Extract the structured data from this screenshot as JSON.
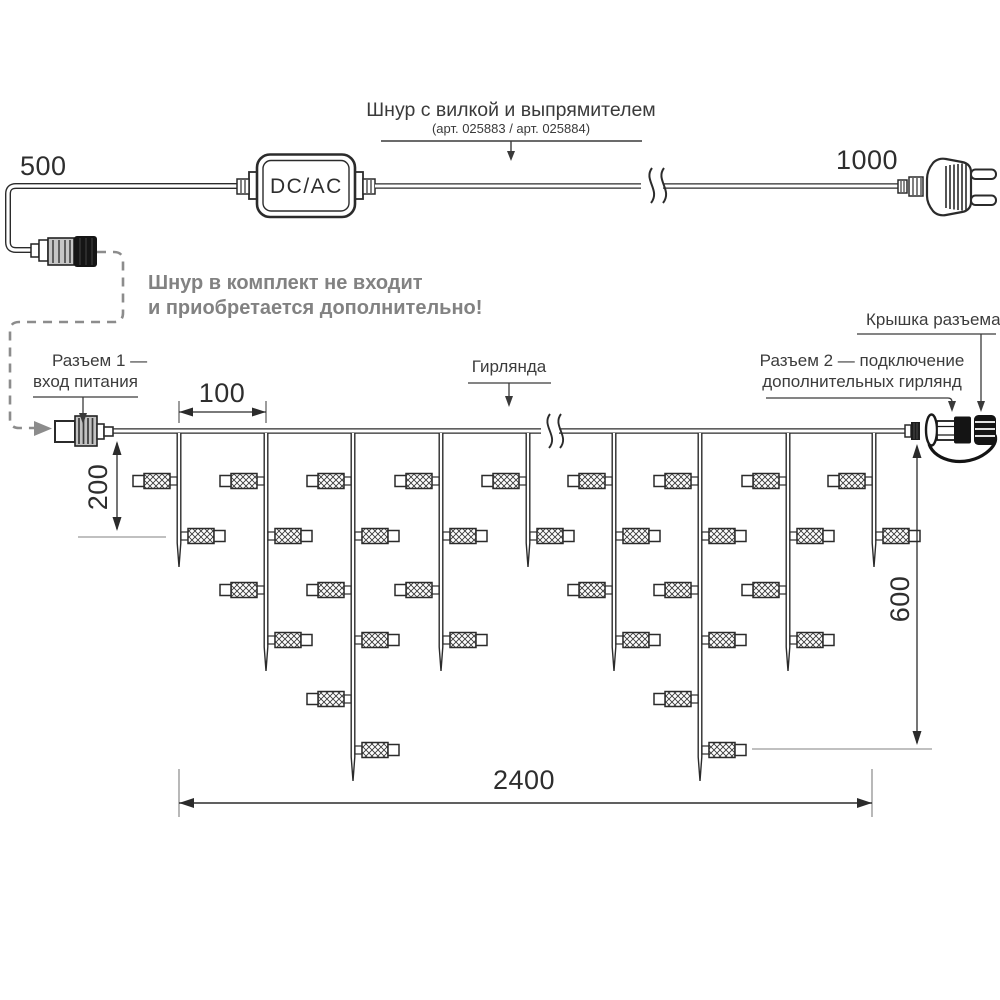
{
  "power_cord": {
    "title": "Шнур с вилкой и выпрямителем",
    "subtitle": "(арт. 025883 / арт. 025884)",
    "converter_label": "DC/AC",
    "left_length_label": "500",
    "right_length_label": "1000",
    "note_line1": "Шнур в комплект не входит",
    "note_line2": "и приобретается дополнительно!"
  },
  "garland": {
    "label": "Гирлянда",
    "connector1_line1": "Разъем 1 —",
    "connector1_line2": "вход питания",
    "connector2_line1": "Разъем 2 — подключение",
    "connector2_line2": "дополнительных гирлянд",
    "cap_label": "Крышка разъема"
  },
  "dimensions": {
    "strand_spacing": "100",
    "first_drop": "200",
    "max_drop": "600",
    "total_length": "2400"
  },
  "colors": {
    "line": "#2b2b2b",
    "gray_leader": "#8c8c8c",
    "note_text": "#828282",
    "black_part": "#141414"
  },
  "geometry": {
    "wire_y": 431,
    "strand_xs": [
      179,
      266,
      353,
      441,
      528,
      614,
      700,
      788,
      874
    ],
    "lamp_counts": [
      2,
      4,
      6,
      4,
      2,
      4,
      6,
      4,
      2
    ],
    "lamp_rows_y": [
      481,
      536,
      590,
      640,
      699,
      750
    ],
    "tip_extra": 31
  }
}
